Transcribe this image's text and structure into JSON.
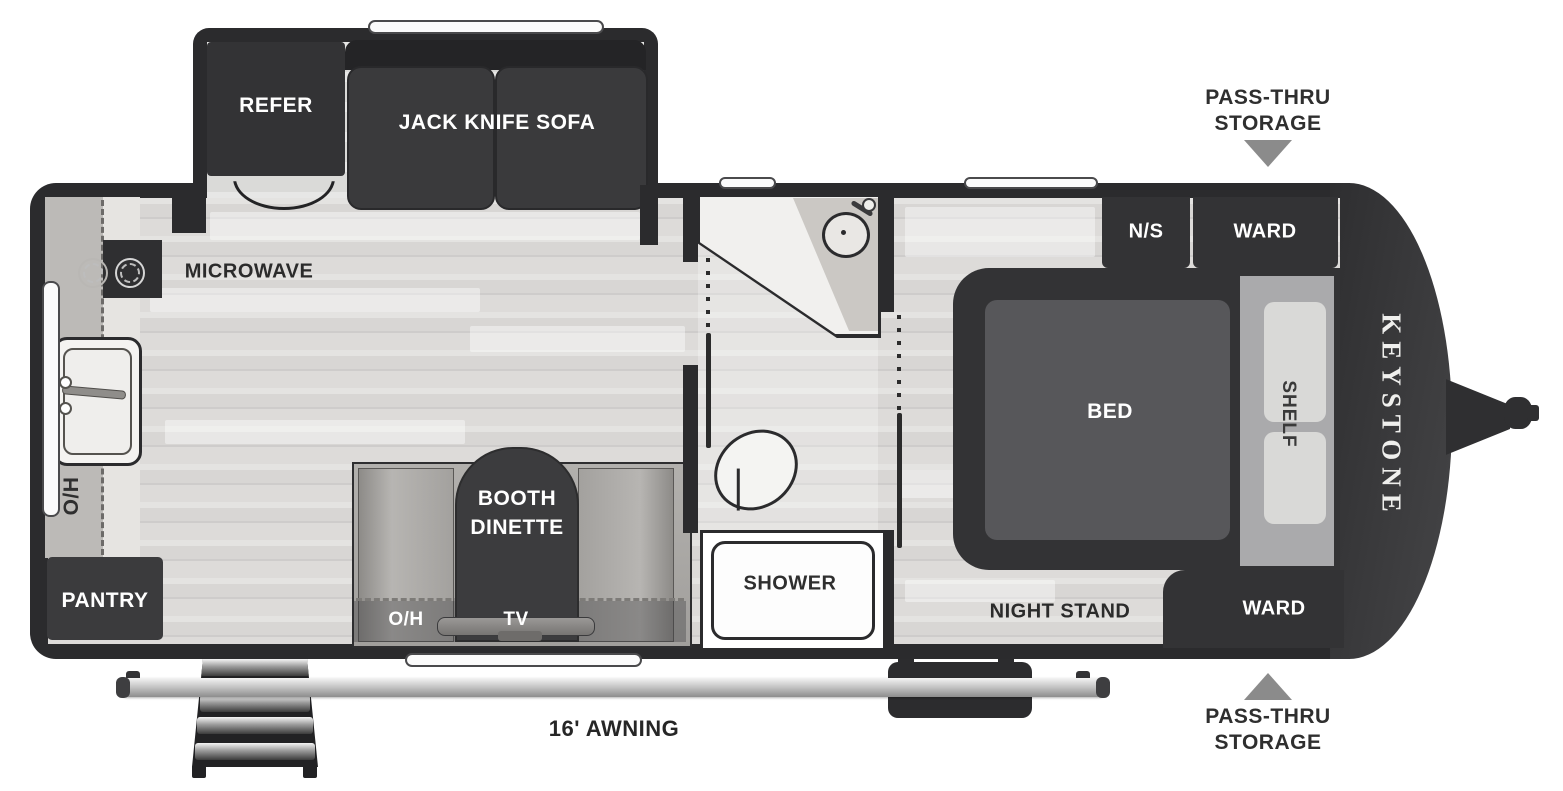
{
  "title": "Keystone travel trailer floor plan",
  "brand": {
    "name": "KEYSTONE"
  },
  "exterior": {
    "awning": "16' AWNING",
    "pass_thru_top": [
      "PASS-THRU",
      "STORAGE"
    ],
    "pass_thru_bottom": [
      "PASS-THRU",
      "STORAGE"
    ]
  },
  "labels": {
    "slideout": {
      "refer": "REFER",
      "sofa": "JACK KNIFE SOFA"
    },
    "kitchen": {
      "microwave": "MICROWAVE",
      "overhead": "O/H",
      "pantry": "PANTRY"
    },
    "dinette": {
      "line1": "BOOTH",
      "line2": "DINETTE",
      "overhead": "O/H",
      "tv": "TV"
    },
    "bathroom": {
      "shower": "SHOWER"
    },
    "bedroom": {
      "bed": "BED",
      "shelf": "SHELF",
      "night_stand_abbr": "N/S",
      "ward_front": "WARD",
      "ward_rear": "WARD",
      "night_stand": "NIGHT STAND"
    }
  },
  "colors": {
    "wall": "#2b2b2d",
    "furniture_dark": "#343436",
    "floor": "#d8d6d4",
    "bench": "#9e9c99",
    "arrow": "#8b8b8b",
    "metal": "#c9c9c9"
  }
}
